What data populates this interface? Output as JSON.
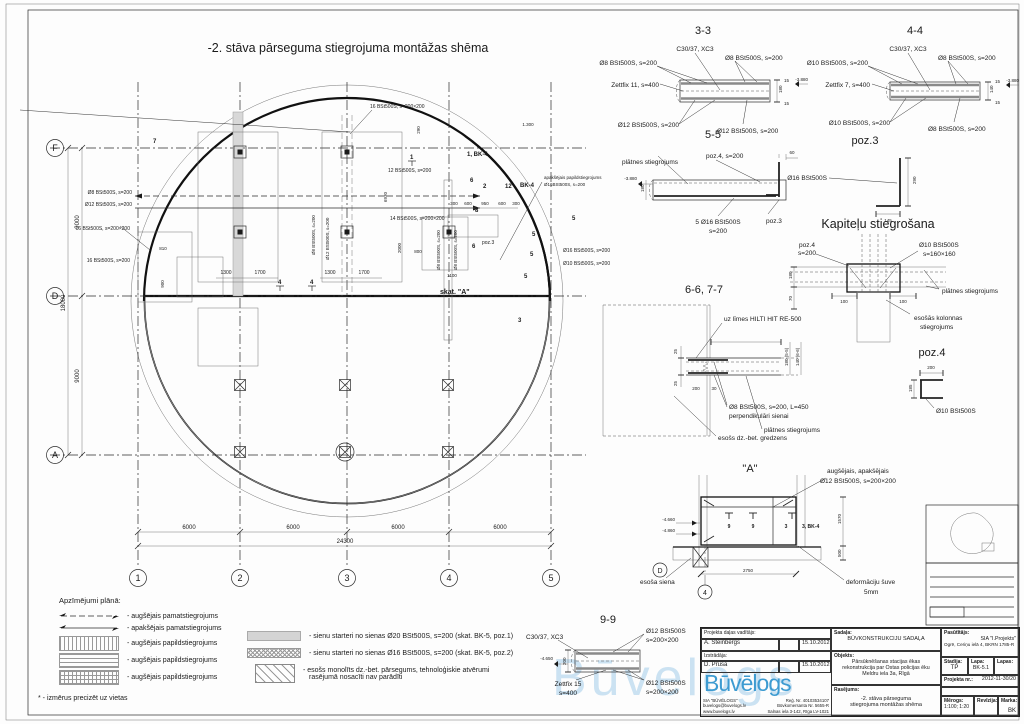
{
  "sheet": {
    "watermark": "Būvelogs"
  },
  "plan": {
    "title": "-2. stāva pārseguma stiegrojuma montāžas shēma",
    "col_bubbles": [
      "1",
      "2",
      "3",
      "4",
      "5"
    ],
    "row_bubbles": [
      "F",
      "D",
      "A"
    ],
    "dim_bottom": [
      "6000",
      "6000",
      "6000",
      "6000"
    ],
    "dim_bottom_total": "24300",
    "dim_left": [
      "9000",
      "9000"
    ],
    "dim_left_total": "18000",
    "annotations": [
      "16 BSt500S, s=200×200",
      "Ø8 BSt500S, s=200",
      "Ø12 BSt500S, s=200",
      "16 BSt500S, s=200×200",
      "16 BSt500S, s=200",
      "12 BSt500S, s=200",
      "14 BSt500S, s=200×200",
      "1, BK-4",
      "BK-4",
      "apakšējais papildstiegrojums",
      "Ø16BSt500S, s=200",
      "skat. \"A\"",
      "poz.3",
      "Ø8 BSt500S, s=200",
      "Ø12 BSt500S, s=200",
      "Ø8 BSt500S, s=200",
      "Ø8 BSt500S, s=200",
      "Ø16 BSt500S, s=200",
      "Ø10 BSt500S, s=200"
    ],
    "dims": [
      "1300",
      "1700",
      "1300",
      "1700",
      "300",
      "600",
      "950",
      "600",
      "300",
      "2000",
      "800",
      "1100",
      "810",
      "900",
      "6930",
      "1.300",
      "290"
    ],
    "marks": [
      "1",
      "6",
      "2",
      "12",
      "8",
      "6",
      "5",
      "5",
      "5",
      "5",
      "3",
      "4",
      "4",
      "7"
    ]
  },
  "s33": {
    "title": "3-3",
    "concrete": "C30/37, XC3",
    "top_left": "Ø8 BSt500S, s=200",
    "top_right": "Ø8 BSt500S, s=200",
    "zettfix": "Zettfix 11, s=400",
    "bot_left": "Ø12 BSt500S, s=200",
    "bot_right": "Ø12 BSt500S, s=200",
    "d1": "15",
    "d2": "180",
    "d3": "15",
    "elev": "-3.880"
  },
  "s44": {
    "title": "4-4",
    "concrete": "C30/37, XC3",
    "top_left": "Ø10 BSt500S, s=200",
    "top_right": "Ø8 BSt500S, s=200",
    "zettfix": "Zettfix 7, s=400",
    "bot_left": "Ø10 BSt500S, s=200",
    "bot_right": "Ø8 BSt500S, s=200",
    "d1": "15",
    "d2": "140",
    "d3": "15",
    "elev": "-3.880"
  },
  "s55": {
    "title": "5-5",
    "plate": "plātnes stiegrojums",
    "poz4": "poz.4, s=200",
    "bars1": "5 Ø16 BSt500S",
    "bars2": "s=200",
    "poz3": "poz.3",
    "d60": "60",
    "d180": "180",
    "elev": "-3.880"
  },
  "poz3": {
    "title": "poz.3",
    "bar": "Ø16 BSt500S",
    "dv": "290",
    "dh": "145"
  },
  "kap": {
    "title": "Kapiteļu stiegrošana",
    "poz4a": "poz.4",
    "poz4b": "s=200",
    "bars1": "Ø10 BSt500S",
    "bars2": "s=160×160",
    "plate": "plātnes stiegrojums",
    "col1": "esošās kolonnas",
    "col2": "stiegrojums",
    "d180": "180",
    "d70": "70",
    "d100a": "100",
    "d100b": "100"
  },
  "s66": {
    "title": "6-6, 7-7",
    "glue": "uz līmes HILTI HIT RE-500",
    "bars1": "Ø8 BSt500S, s=200, L=450",
    "bars2": "perpendikulāri sienai",
    "plate": "plātnes stiegrojums",
    "ring": "esošs dz.-bet. gredzens",
    "d25a": "25",
    "d25b": "25",
    "d200": "200",
    "d30": "30",
    "dr1": "180 (5-5)",
    "dr2": "140 (6-6)"
  },
  "poz4": {
    "title": "poz.4",
    "bar": "Ø10 BSt500S",
    "dh": "200",
    "dv": "185"
  },
  "detA": {
    "title": "\"A\"",
    "note1": "augšējais, apakšējais",
    "note2": "Ø12 BSt500S, s=200×200",
    "elev1": "-4.660",
    "elev2": "-4.860",
    "m1": "9",
    "m2": "9",
    "m3": "3",
    "m4": "3, BK-4",
    "wall": "esoša siena",
    "joint1": "deformāciju šuve",
    "joint2": "5mm",
    "d2750": "2750",
    "d1570": "1570",
    "d500": "500",
    "bub_d": "D",
    "bub_4": "4"
  },
  "s99": {
    "title": "9-9",
    "concrete": "C30/37, XC3",
    "top1": "Ø12 BSt500S",
    "top2": "s=200×200",
    "zett1": "Zettfix 15",
    "zett2": "s=400",
    "bot1": "Ø12 BSt500S",
    "bot2": "s=200×200",
    "elev": "-4.650",
    "d200": "200"
  },
  "legend": {
    "title": "Apzīmējumi plānā:",
    "items": [
      "- augšējais pamatstiegrojums",
      "- apakšējais pamatstiegrojums",
      "- augšējais papildstiegrojums",
      "- augšējais papildstiegrojums",
      "- augšējais papildstiegrojums"
    ],
    "right1": "- sienu starteri no sienas Ø20 BSt500S, s=200 (skat. BK-5, poz.1)",
    "right2": "- sienu starteri no sienas Ø16 BSt500S, s=200 (skat. BK-5, poz.2)",
    "right3a": "- esošs monolīts dz.-bet. pārsegums, tehnoloģiskie atvērumi",
    "right3b": "rasējumā nosacīti nav parādīti",
    "footnote": "* - izmērus precizēt uz vietas"
  },
  "tb": {
    "role1": "Projekta daļas vadītājs:",
    "name1": "A. Šteinbergs",
    "date1": "15.10.2012",
    "role2": "Izstrādāja:",
    "name2": "D. Prūsa",
    "date2": "15.10.2012",
    "logo": "Būvēlogs",
    "company": "SIA \"BŪVĒLOGS\"",
    "email": "buvelogs@buvelogs.lv",
    "web": "www.buvelogs.lv",
    "reg": "Reģ. Nr. 40103534107",
    "reg2": "Būvkomersanta Nr. 5655-R",
    "addr": "Salnas iela 3-142, Rīga LV-1021",
    "sadala_label": "Sadaļa:",
    "sadala": "BŪVKONSTRUKCIJU SADAĻA",
    "objekts_label": "Objekts:",
    "objekts1": "Pārsūknēšanas stacijas ēkas",
    "objekts2": "rekonstrukcija par Ostas policijas ēku",
    "objekts3": "Meldru iela 3a, Rīgā",
    "rasejums_label": "Rasējums:",
    "rasejums1": "-2. stāva pārseguma",
    "rasejums2": "stiegrojuma montāžas shēma",
    "pasut_label": "Pasūtītājs:",
    "pasut1": "SIA \"I.Projekts\"",
    "pasut2": "Ogrē, Ceriņu ielā 4, BKRN 1785-R",
    "stadija_label": "Stadija:",
    "stadija": "TP",
    "lapa_label": "Lapa:",
    "lapa": "BK-5.1",
    "lapas_label": "Lapas:",
    "lapas": "",
    "projekta_label": "Projekta nr.:",
    "projekta": "2012-11-30/20",
    "fails_label": "Fails:",
    "fails": "",
    "merogs_label": "Mērogs:",
    "merogs": "1:100; 1:20",
    "rev_label": "Revīzija:",
    "rev": "",
    "marka_label": "Marka:",
    "marka": "BK"
  }
}
